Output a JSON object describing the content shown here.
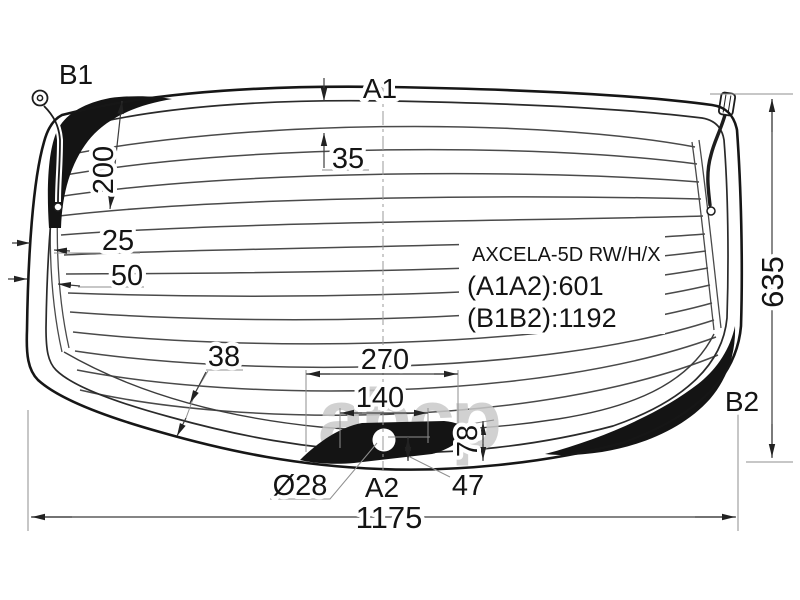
{
  "diagram": {
    "info": {
      "model": "AXCELA-5D RW/H/X",
      "a_len": "(A1A2):601",
      "b_len": "(B1B2):1192"
    },
    "markers": {
      "b1": "B1",
      "a1": "A1",
      "a2": "A2",
      "b2": "B2"
    },
    "dims": {
      "d35": "35",
      "d200": "200",
      "d25": "25",
      "d50": "50",
      "d38": "38",
      "d270": "270",
      "d140": "140",
      "d28": "Ø28",
      "d47": "47",
      "d78": "78",
      "d635": "635",
      "d1175": "1175"
    },
    "watermark": "abcp",
    "colors": {
      "line": "#161616",
      "black_fill": "#141414",
      "thin_line": "#8f8f8f",
      "watermark": "#c9c9c9",
      "background": "#ffffff"
    }
  }
}
